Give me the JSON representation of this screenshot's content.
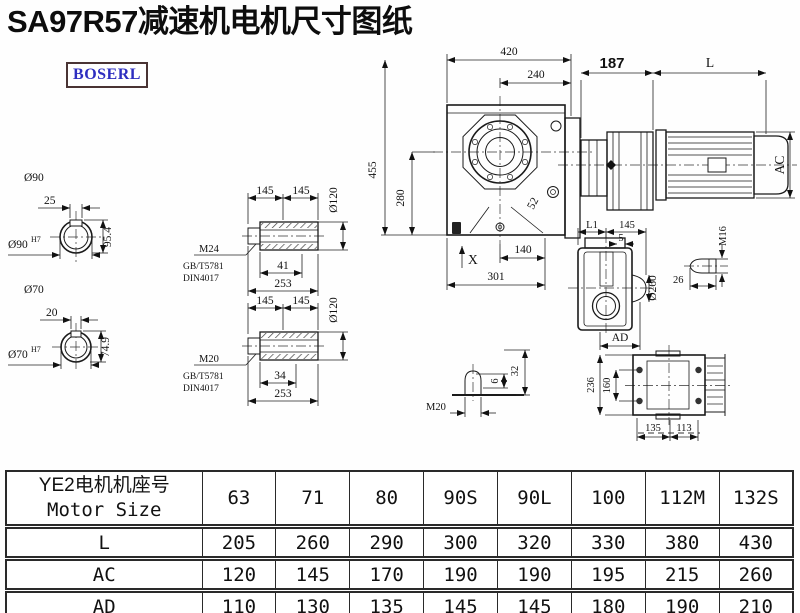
{
  "title": "SA97R57减速机电机尺寸图纸",
  "logo": {
    "text": "BOSERL"
  },
  "colors": {
    "logo_text": "#2e2ec0",
    "logo_border": "#4a3434",
    "line": "#1a1a1a",
    "table_border": "#2a2a2a"
  },
  "drawing": {
    "shaft_end_top": {
      "dia_label": "Ø90",
      "key_width": "25",
      "height": "95.4",
      "bore": "Ø90",
      "bore_tol": "H7"
    },
    "shaft_end_bottom": {
      "dia_label": "Ø70",
      "key_width": "20",
      "height": "74.9",
      "bore": "Ø70",
      "bore_tol": "H7"
    },
    "hollow_shaft_top": {
      "len_a": "145",
      "len_b": "145",
      "dia": "Ø120",
      "thread": "M24",
      "std_gb": "GB/T5781",
      "std_din": "DIN4017",
      "depth": "41",
      "total_len": "253"
    },
    "hollow_shaft_bottom": {
      "len_a": "145",
      "len_b": "145",
      "dia": "Ø120",
      "thread": "M20",
      "std_gb": "GB/T5781",
      "std_din": "DIN4017",
      "depth": "34",
      "total_len": "253"
    },
    "main_view": {
      "width_total": "420",
      "width_half": "240",
      "height_total": "455",
      "height_center": "280",
      "hole_dim": "52",
      "foot_a": "140",
      "foot_b": "301",
      "x_mark": "X",
      "motor_flange": "187",
      "motor_len": "L",
      "motor_dia": "AC"
    },
    "side_view": {
      "dim_l1": "L1",
      "dim_145": "145",
      "dim_5": "5",
      "flange_dia": "Ø260",
      "dim_ad": "AD"
    },
    "plug_detail": {
      "thread": "M16",
      "len": "26"
    },
    "breather_detail": {
      "thread": "M20",
      "dim_6": "6",
      "dim_32": "32"
    },
    "rear_view": {
      "height": "236",
      "bolt_spacing": "160",
      "foot_a": "135",
      "foot_b": "113"
    }
  },
  "table": {
    "header": {
      "zh": "YE2电机机座号",
      "en": "Motor Size"
    },
    "columns": [
      "63",
      "71",
      "80",
      "90S",
      "90L",
      "100",
      "112M",
      "132S"
    ],
    "rows": [
      {
        "label": "L",
        "values": [
          "205",
          "260",
          "290",
          "300",
          "320",
          "330",
          "380",
          "430"
        ]
      },
      {
        "label": "AC",
        "values": [
          "120",
          "145",
          "170",
          "190",
          "190",
          "195",
          "215",
          "260"
        ]
      },
      {
        "label": "AD",
        "values": [
          "110",
          "130",
          "135",
          "145",
          "145",
          "180",
          "190",
          "210"
        ]
      }
    ]
  }
}
